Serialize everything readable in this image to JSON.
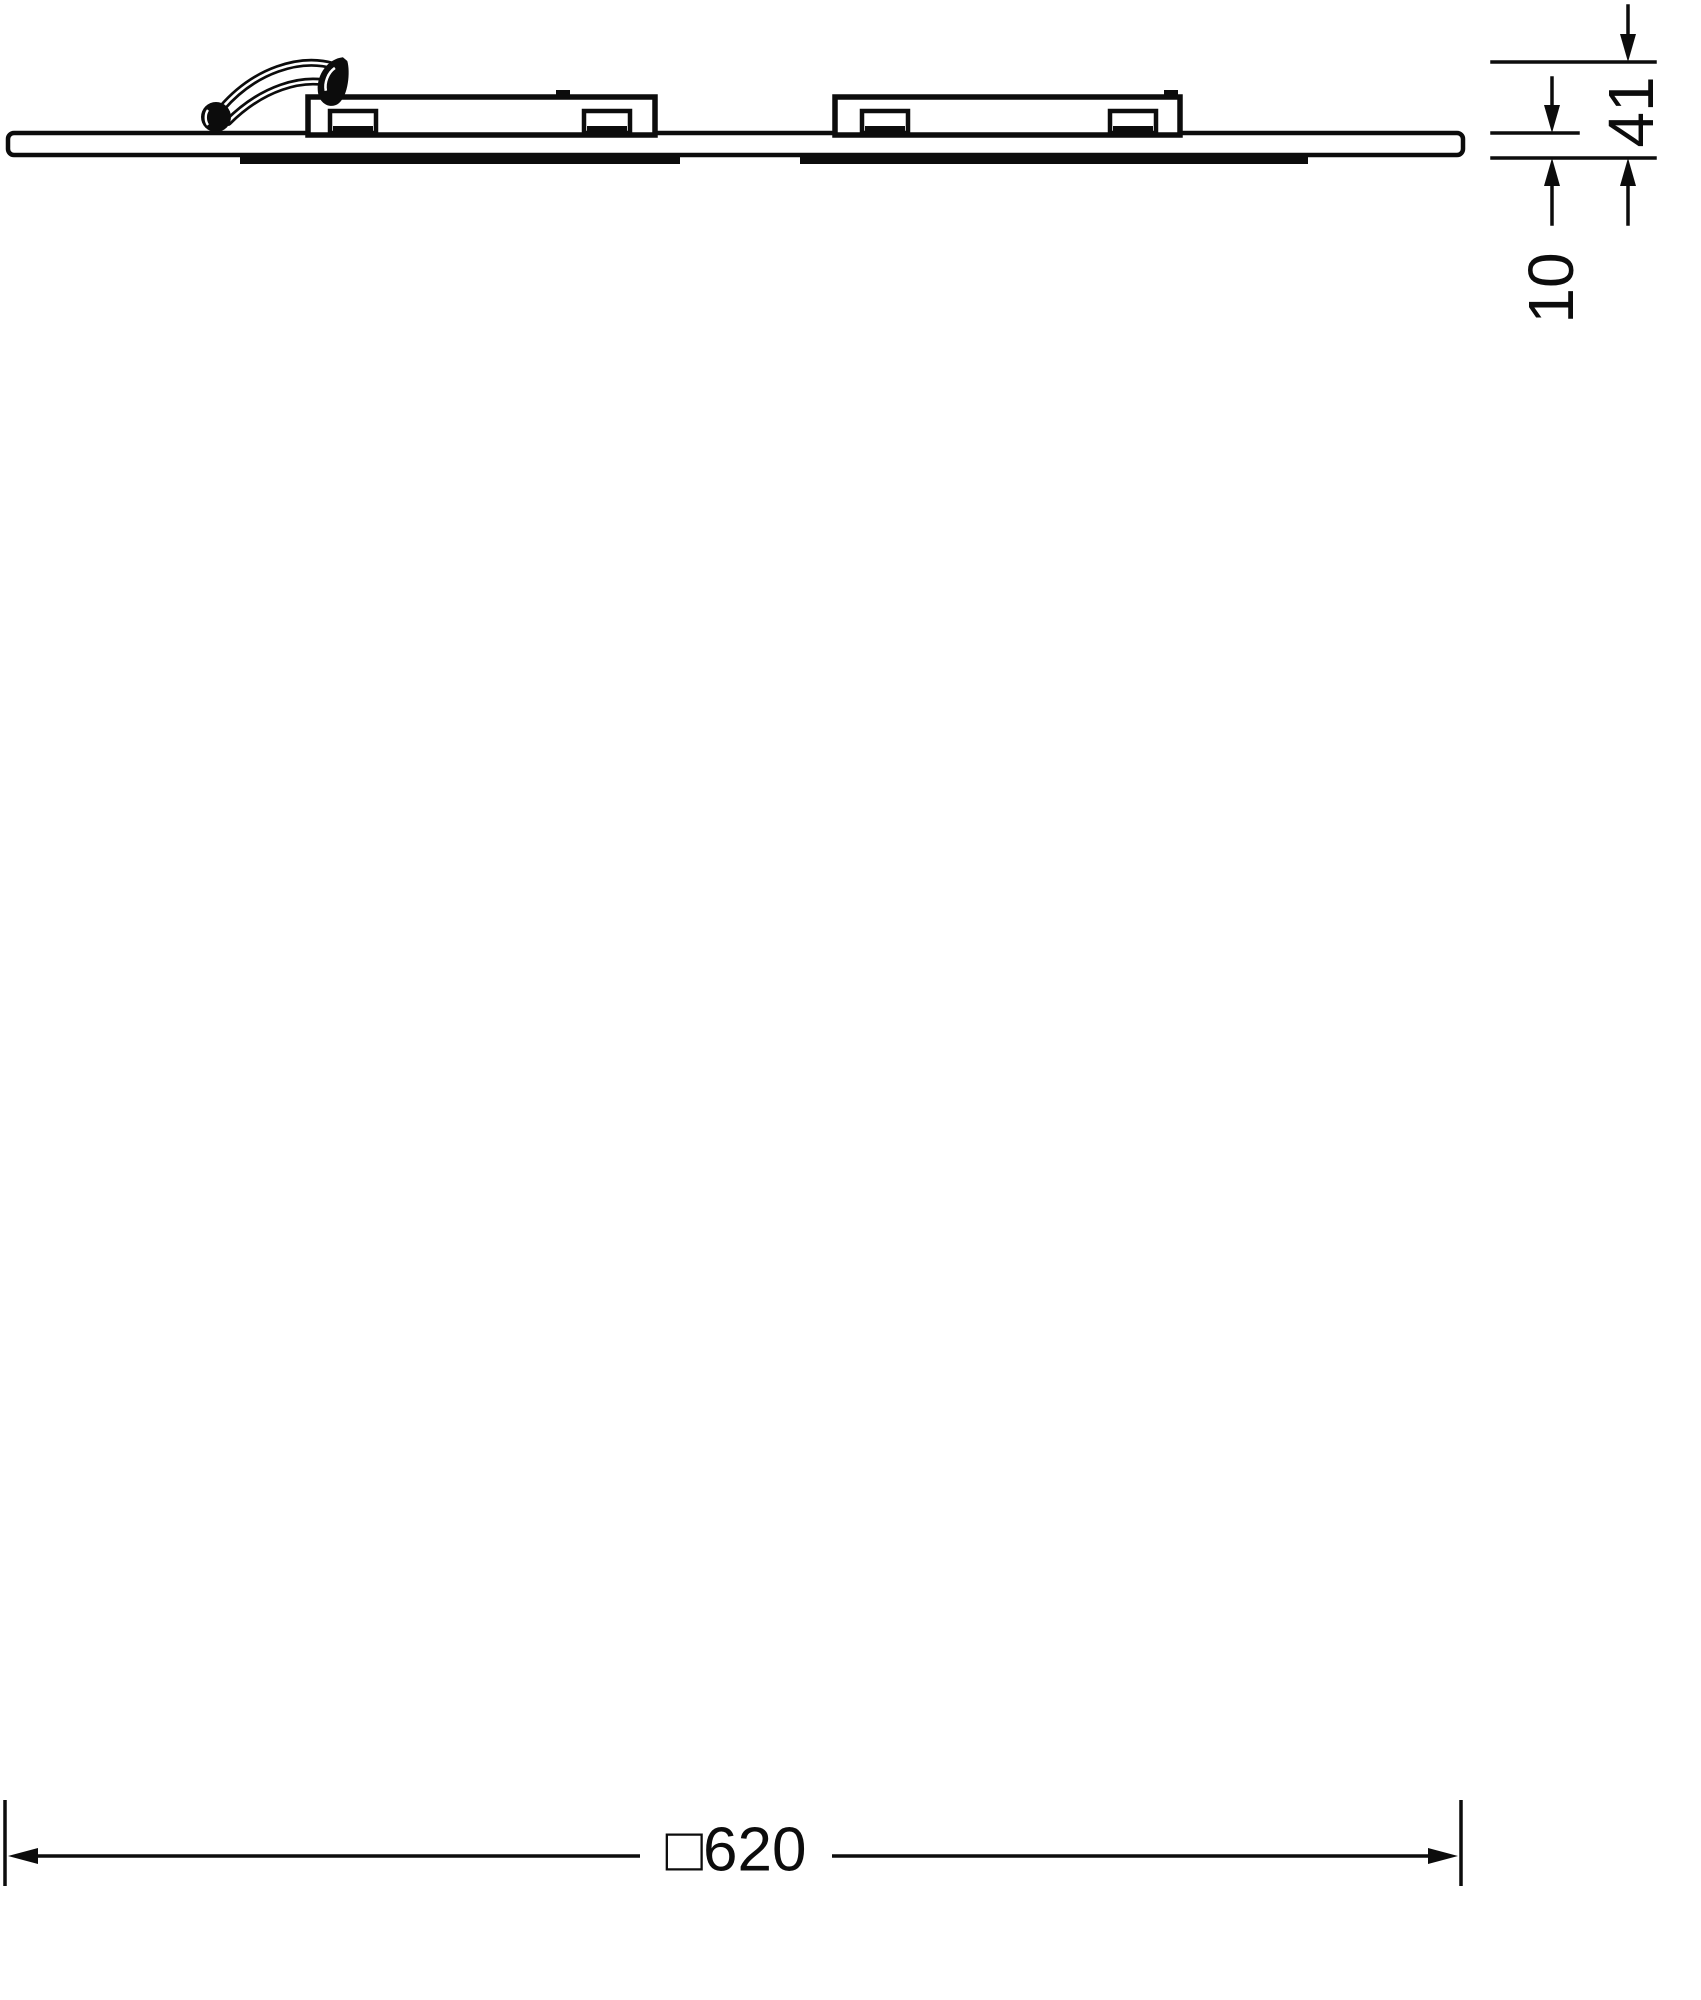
{
  "drawing": {
    "title": "LED panel luminaire dimensional drawing",
    "views": {
      "side_profile": "side view with mounted gear",
      "rear_view": "rear view of panel"
    }
  },
  "dims": {
    "total_height": "41",
    "panel_thickness": "10",
    "outer_width": "□620"
  },
  "components": {
    "led_module_count": 4,
    "cable_connector_count": 4,
    "mounting_bracket_count": 4,
    "driver": "LED driver with mounting plate",
    "panel": "square panel frame"
  },
  "colors": {
    "ink": "#0c0c0c",
    "paper": "#ffffff"
  }
}
